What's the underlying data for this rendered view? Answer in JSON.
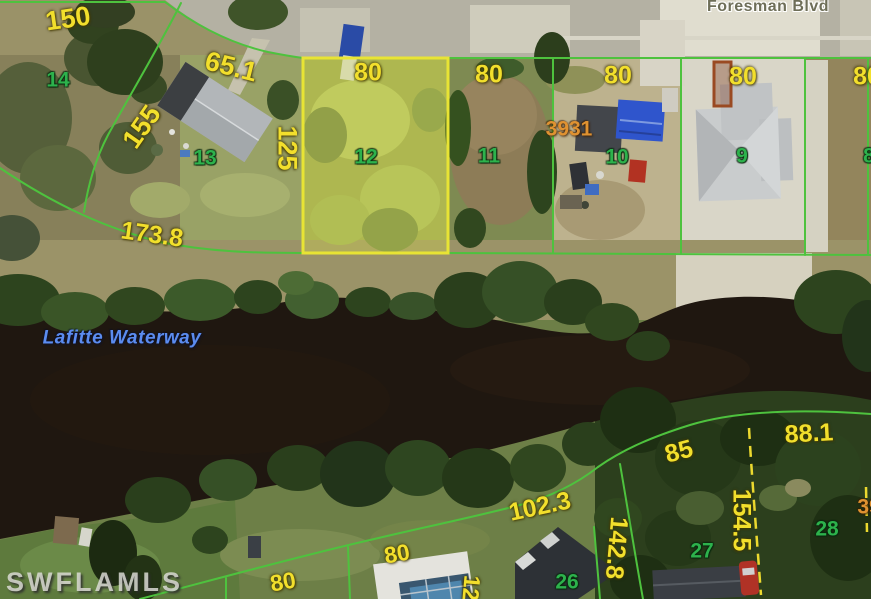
{
  "street": {
    "name": "Foresman Blvd"
  },
  "waterway": {
    "name": "Lafitte Waterway"
  },
  "watermark": "SWFLAMLS",
  "subject_parcel": {
    "lot_number": "12",
    "frontage": "80",
    "depth": "125"
  },
  "lot_numbers": {
    "lot14": "14",
    "lot13": "13",
    "lot12": "12",
    "lot11": "11",
    "lot10": "10",
    "lot9": "9",
    "lot8_partial": "8",
    "lot28": "28",
    "lot27": "27",
    "lot26": "26"
  },
  "dimensions": {
    "top_left_150": "150",
    "lot13_frontage_65_1": "65.1",
    "lot13_side_155": "155",
    "lot12_depth_125": "125",
    "lot13_rear_173_8": "173.8",
    "lot12_frontage_80": "80",
    "lot11_frontage_80": "80",
    "lot10_frontage_80": "80",
    "lot9_frontage_80": "80",
    "lot8_frontage_80_partial": "80",
    "rear_88_1": "88.1",
    "rear_85": "85",
    "side_154_5": "154.5",
    "side_142_8": "142.8",
    "rear_102_3": "102.3",
    "bottom_mid_80": "80",
    "bottom_left_80": "80",
    "bottom_12_partial": "12"
  },
  "addresses": {
    "lot10_address": "3931",
    "right_edge_partial": "39"
  },
  "colors": {
    "lot_line_green": "#4ec23e",
    "subject_lot_yellow": "#e8e434",
    "dimension_text_yellow": "#f2df2c",
    "lot_number_green": "#2db24c",
    "address_text_orange": "#e09231",
    "waterway_text_blue": "#5b8cf0",
    "water_dark": "#1f1710"
  }
}
